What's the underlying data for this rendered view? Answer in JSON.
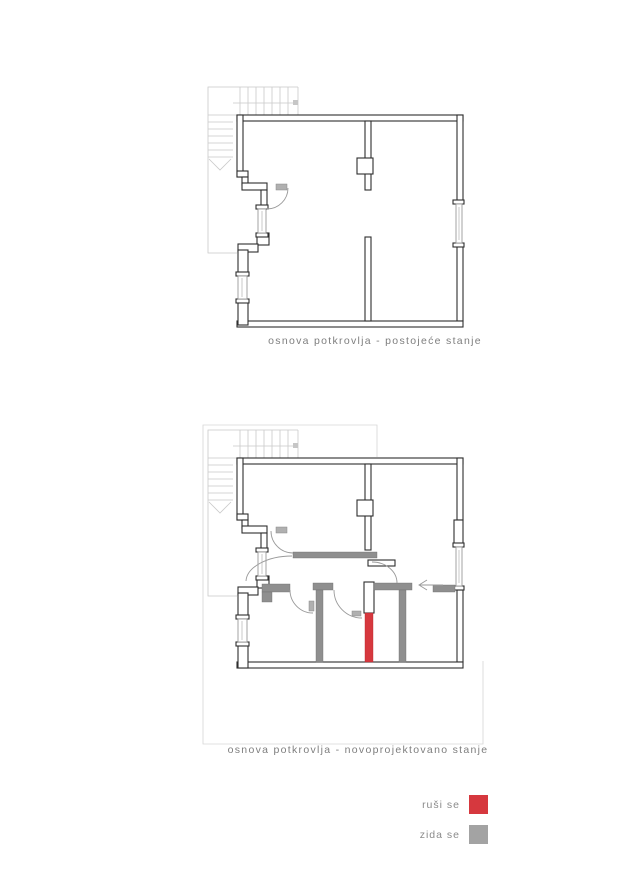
{
  "document": {
    "type": "architectural-floor-plan-sheet",
    "background": "#ffffff"
  },
  "plans": [
    {
      "id": "existing",
      "caption": "osnova potkrovlja - postojeće stanje"
    },
    {
      "id": "proposed",
      "caption": "osnova potkrovlja - novoprojektovano stanje"
    }
  ],
  "legend": {
    "items": [
      {
        "label": "ruši se",
        "color": "#d6383e"
      },
      {
        "label": "zida se",
        "color": "#a3a3a3"
      }
    ]
  },
  "colors": {
    "demolish": "#d6383e",
    "build": "#8f8f8f",
    "wall_outline": "#2e2e2e",
    "guide_gray": "#c9c9c9"
  }
}
